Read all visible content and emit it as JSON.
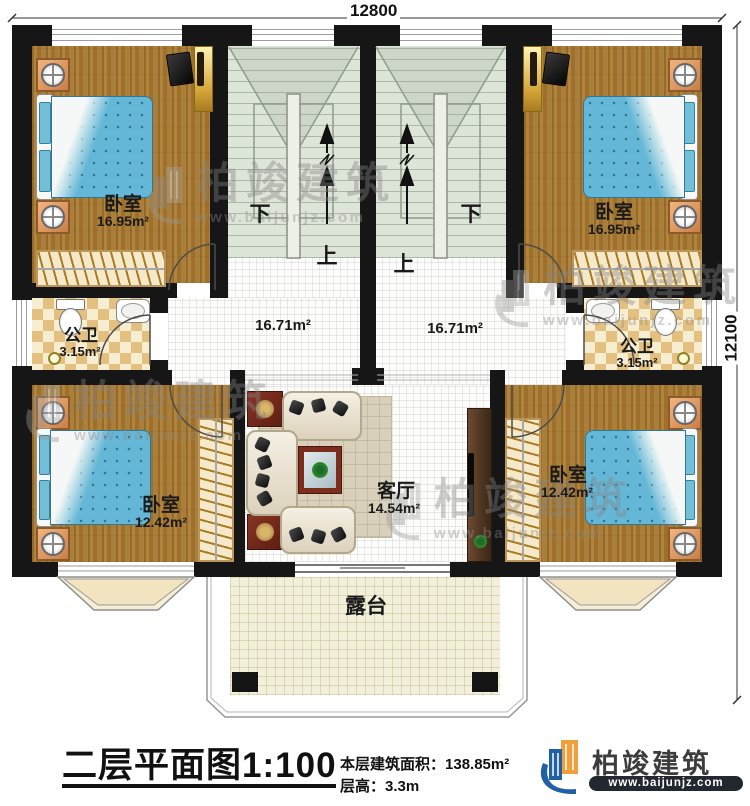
{
  "dimensions": {
    "width": "12800",
    "height": "12100"
  },
  "stairs": {
    "down": "下",
    "up": "上"
  },
  "rooms": {
    "bedroom_tl": {
      "label": "卧室",
      "area": "16.95m²"
    },
    "bedroom_tr": {
      "label": "卧室",
      "area": "16.95m²"
    },
    "bath_l": {
      "label": "公卫",
      "area": "3.15m²"
    },
    "bath_r": {
      "label": "公卫",
      "area": "3.15m²"
    },
    "hall_l": {
      "area": "16.71m²"
    },
    "hall_r": {
      "area": "16.71m²"
    },
    "bedroom_bl": {
      "label": "卧室",
      "area": "12.42m²"
    },
    "bedroom_br": {
      "label": "卧室",
      "area": "12.42m²"
    },
    "living": {
      "label": "客厅",
      "area": "14.54m²"
    },
    "terrace": {
      "label": "露台"
    }
  },
  "title_block": {
    "plan_title": "二层平面图",
    "scale": "1:100",
    "area_label": "本层建筑面积：",
    "area_value": "138.85m²",
    "height_label": "层高：",
    "height_value": "3.3m"
  },
  "brand": {
    "name": "柏竣建筑",
    "url": "www.baijunjz.com"
  }
}
